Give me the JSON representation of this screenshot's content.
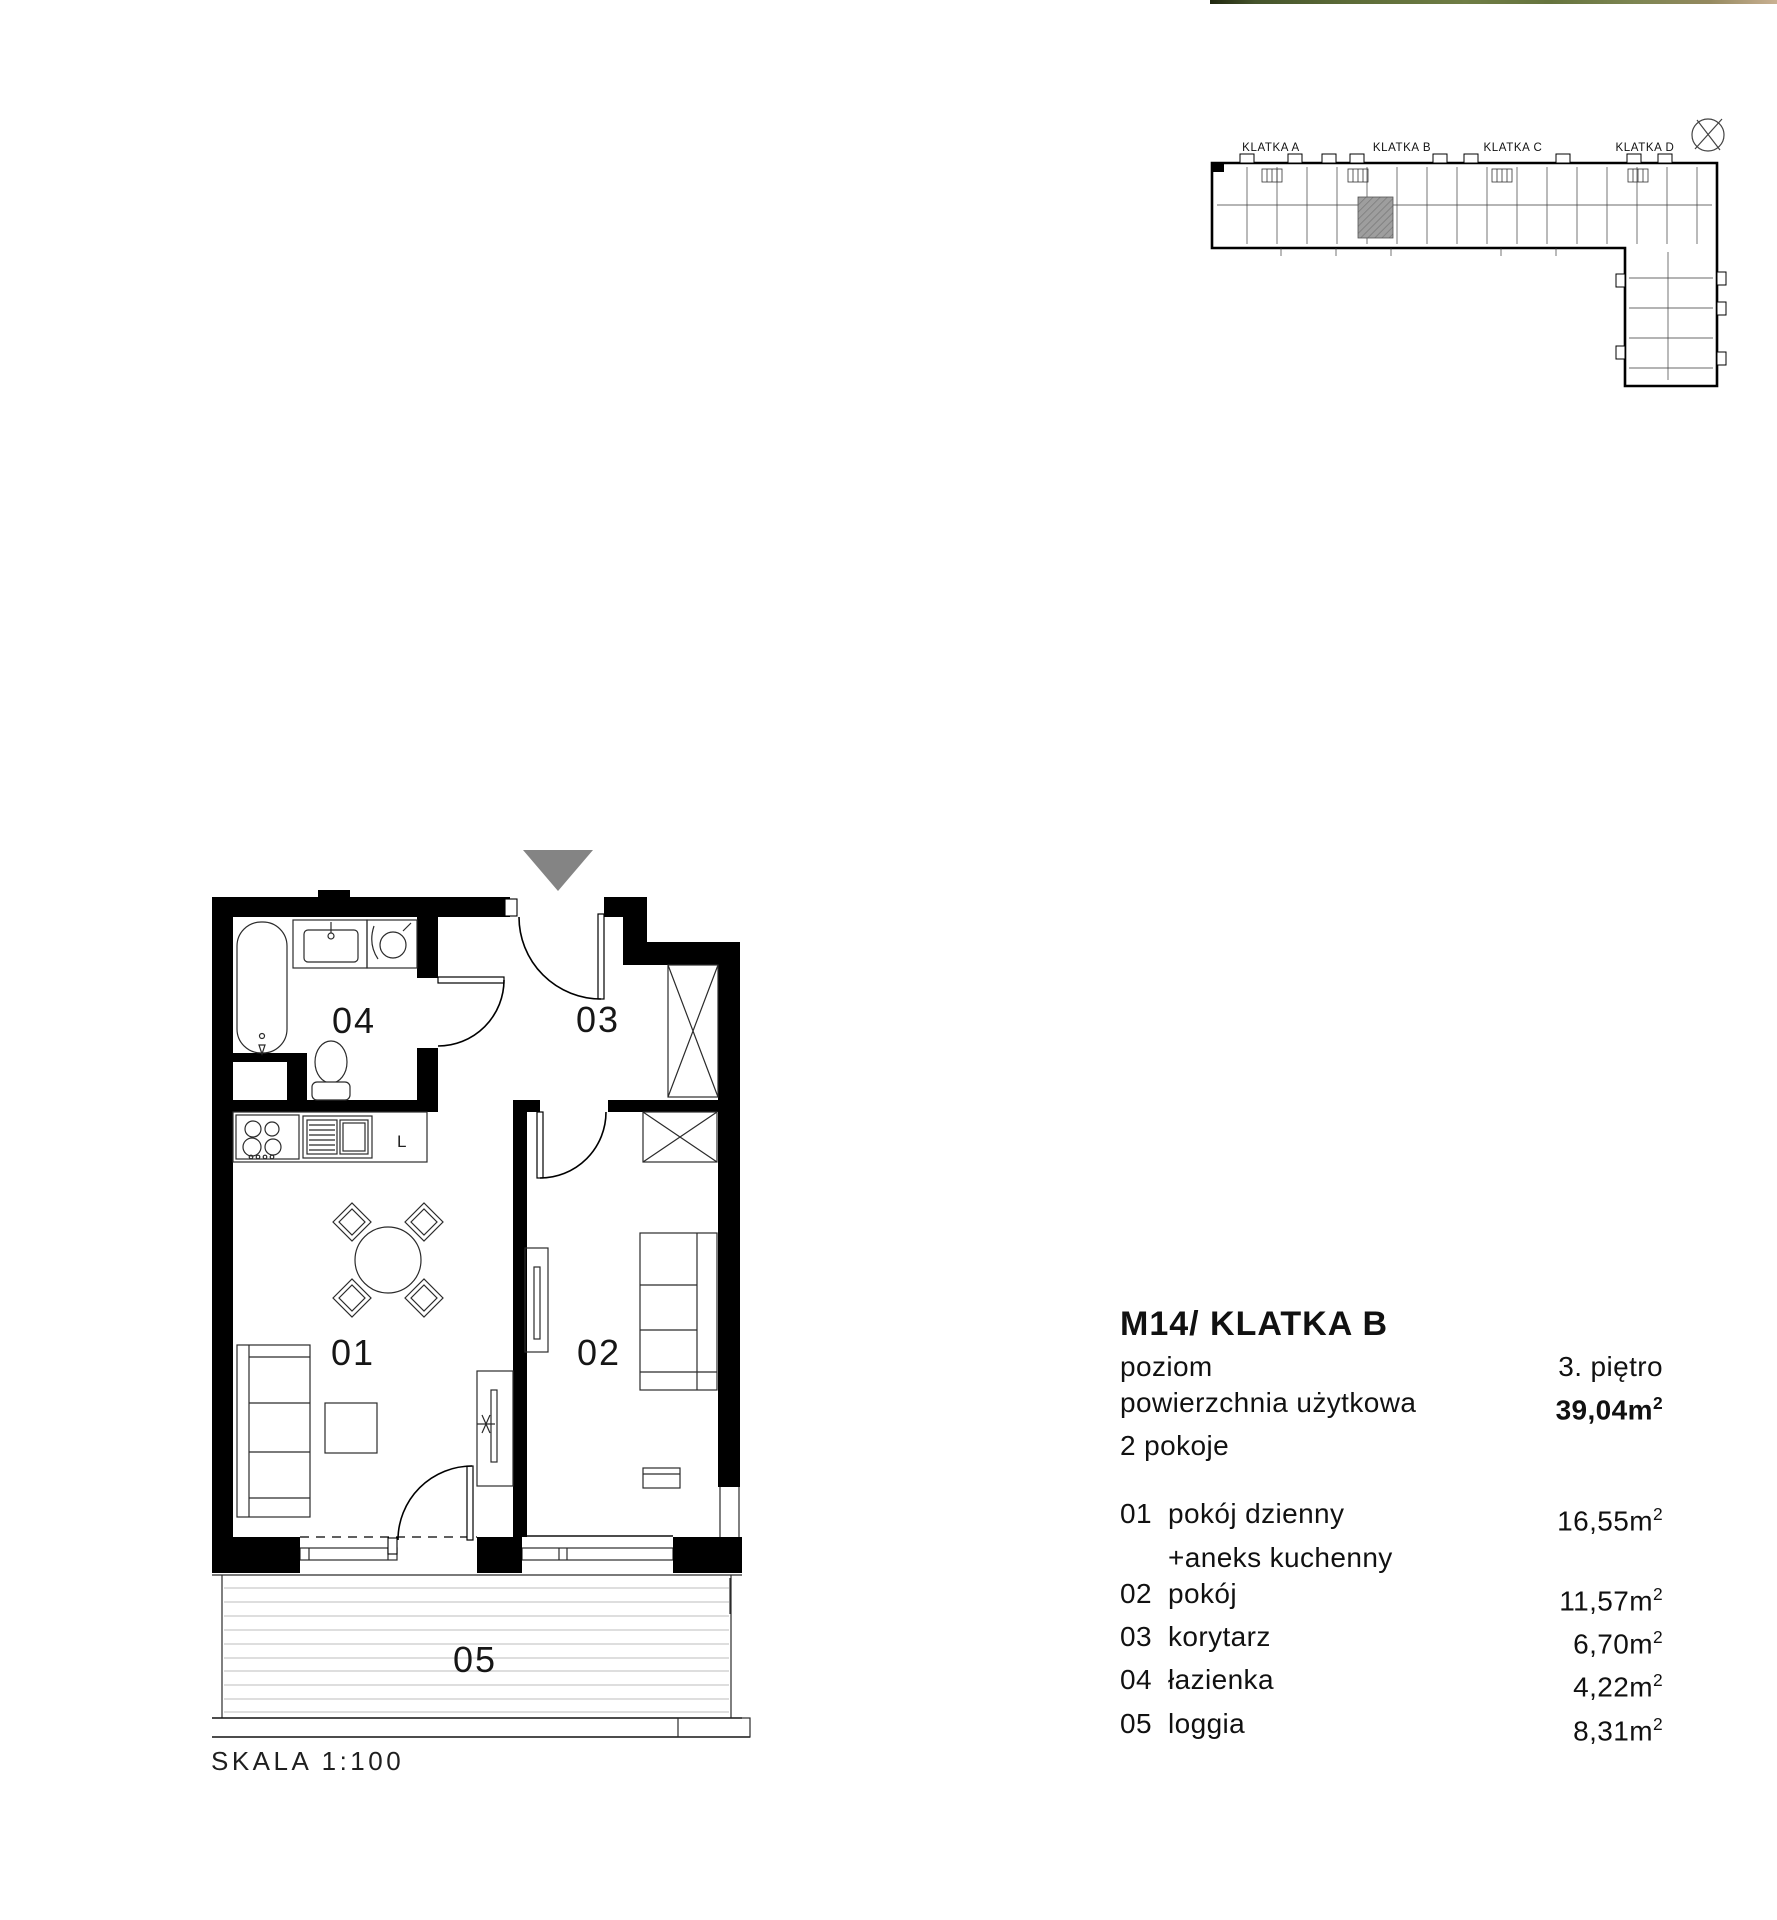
{
  "top_photo_strip": {
    "css": "background:linear-gradient(90deg,#20270f 0%,#45542c 8%,#5d6c38 25%,#6f7d45 45%,#66743e 60%,#7d8552 75%,#94895f 88%,#c9b092 100%)",
    "colors": [
      "#20270f",
      "#5d6c38",
      "#6f7d45",
      "#94895f",
      "#c9b092"
    ]
  },
  "overview": {
    "labels": {
      "klatka_a": "KLATKA A",
      "klatka_b": "KLATKA B",
      "klatka_c": "KLATKA C",
      "klatka_d": "KLATKA D"
    },
    "highlight_color": "#9e9e9e"
  },
  "floor_plan": {
    "room_labels": {
      "r01": "01",
      "r02": "02",
      "r03": "03",
      "r04": "04",
      "r05": "05"
    },
    "kitchen_fridge_label": "L",
    "scale_label": "SKALA 1:100",
    "entrance_arrow_color": "#848484"
  },
  "info_panel": {
    "title": "M14/ KLATKA B",
    "poziom_label": "poziom",
    "poziom_value": "3. piętro",
    "area_label": "powierzchnia użytkowa",
    "area_value": "39,04m",
    "area_sup": "2",
    "rooms_count": "2 pokoje",
    "rooms": [
      {
        "num": "01",
        "name": "pokój dzienny",
        "area": "16,55m",
        "sup": "2"
      },
      {
        "num": "",
        "name": "+aneks kuchenny",
        "area": "",
        "sup": ""
      },
      {
        "num": "02",
        "name": "pokój",
        "area": "11,57m",
        "sup": "2"
      },
      {
        "num": "03",
        "name": "korytarz",
        "area": "6,70m",
        "sup": "2"
      },
      {
        "num": "04",
        "name": "łazienka",
        "area": "4,22m",
        "sup": "2"
      },
      {
        "num": "05",
        "name": "loggia",
        "area": "8,31m",
        "sup": "2"
      }
    ]
  }
}
